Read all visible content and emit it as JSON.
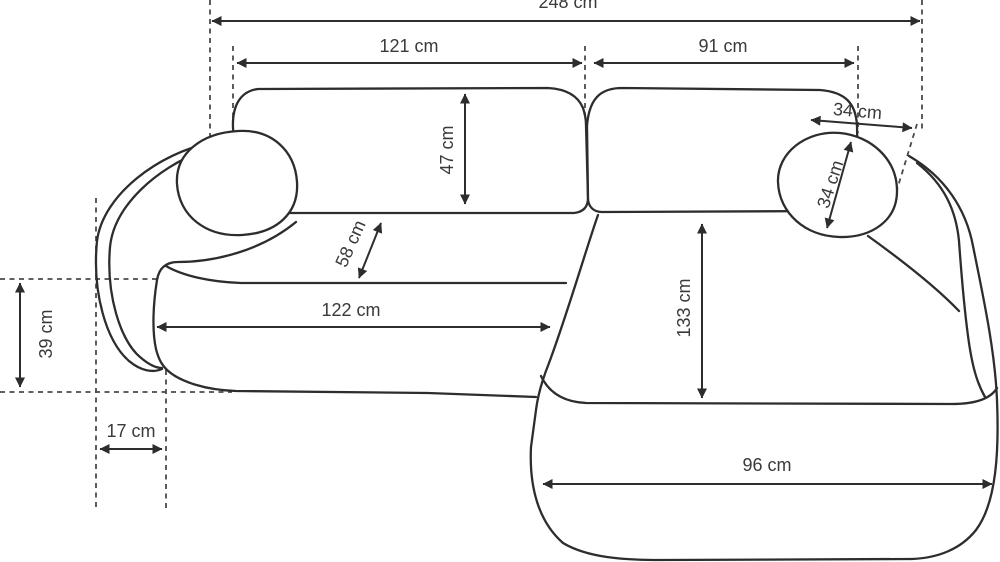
{
  "diagram": {
    "kind": "sofa-dimension-drawing",
    "colors": {
      "background": "#ffffff",
      "outline": "#2d2d2d",
      "dashed_guides": "#4a4a4a",
      "label_text": "#3a3a3a"
    },
    "dimensions": {
      "total_width": "248 cm",
      "left_section_width": "121 cm",
      "right_section_width": "91 cm",
      "backrest_height": "47 cm",
      "backrest_seat_diagonal": "58 cm",
      "seat_length": "122 cm",
      "chaise_length": "133 cm",
      "headrest_width": "34 cm",
      "headrest_height": "34 cm",
      "armrest_side_depth": "39 cm",
      "armrest_front_width": "17 cm",
      "chaise_front_width": "96 cm"
    }
  }
}
